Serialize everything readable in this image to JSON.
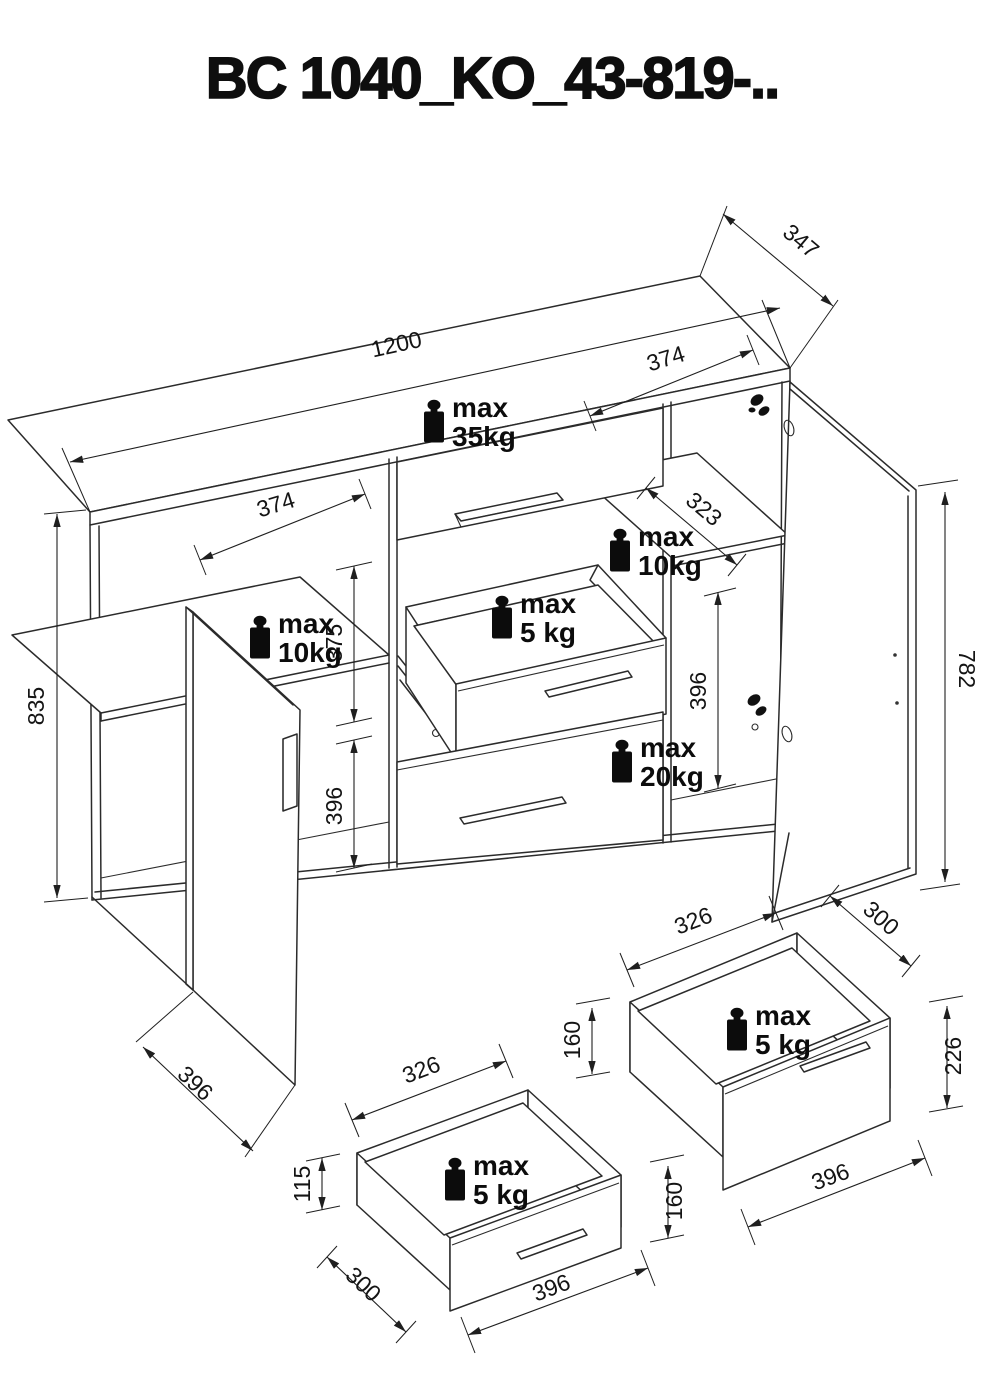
{
  "title": "BC 1040_KO_43-819-..",
  "colors": {
    "line": "#2b2b2b",
    "text": "#141414",
    "background": "#ffffff"
  },
  "main_unit": {
    "dims": {
      "top_width": "1200",
      "top_depth": "347",
      "top_section_right": "374",
      "section_left": "374",
      "height_left": "835",
      "inner_upper_height": "375",
      "inner_lower_height": "396",
      "right_inner_height": "396",
      "right_door_height": "782",
      "left_door_width": "396",
      "right_shelf_depth": "323"
    },
    "loads": {
      "top": {
        "line1": "max",
        "line2": "35kg"
      },
      "left_shelf": {
        "line1": "max",
        "line2": "10kg"
      },
      "right_shelf": {
        "line1": "max",
        "line2": "10kg"
      },
      "middle_drawer": {
        "line1": "max",
        "line2": "5 kg"
      },
      "bottom_drawer": {
        "line1": "max",
        "line2": "20kg"
      }
    }
  },
  "drawer_detail_left": {
    "dims": {
      "inner_width": "326",
      "side_height": "115",
      "depth": "300",
      "front_height": "160",
      "front_width": "396"
    },
    "load": {
      "line1": "max",
      "line2": "5 kg"
    }
  },
  "drawer_detail_right": {
    "dims": {
      "inner_width": "326",
      "depth": "300",
      "side_height": "160",
      "front_height": "226",
      "front_width": "396"
    },
    "load": {
      "line1": "max",
      "line2": "5 kg"
    }
  }
}
